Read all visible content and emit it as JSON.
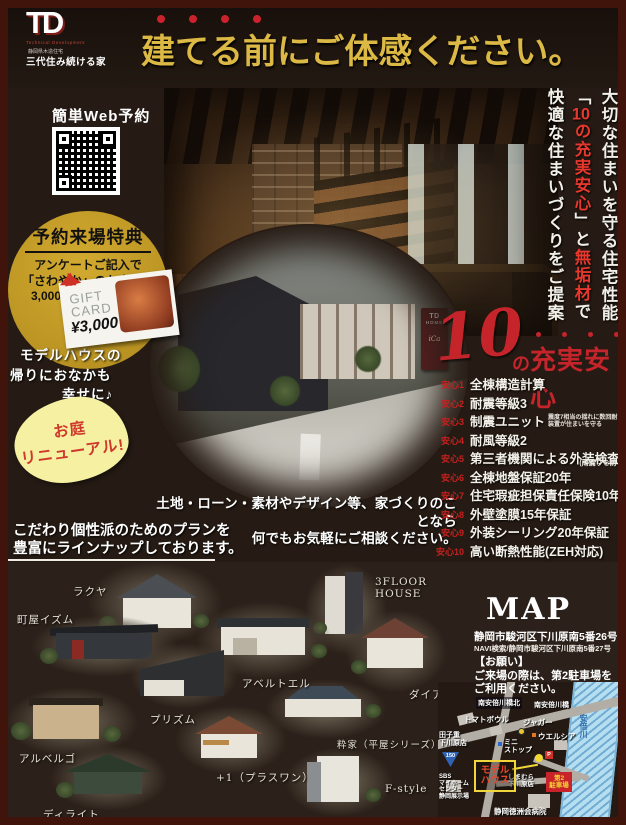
{
  "colors": {
    "accent_red": "#c8232b",
    "title_gold": "#dcb945",
    "circle_gold": "#c49b28",
    "bubble_yellow": "#f6f0a2",
    "map_parking_red": "#c8232b",
    "map_model_yellow": "#f0d63a"
  },
  "brand": {
    "logo": "TD",
    "logo_sub": "Technical Development",
    "tag_small": "静岡県木造住宅",
    "tag_main": "三代住み続ける家"
  },
  "header": {
    "title": "建てる前にご体感ください。"
  },
  "side": {
    "l1": "大切な住まいを守る住宅性能",
    "l2a": "「",
    "l2num": "10",
    "l2b": "の充実安心",
    "l2c": "」と",
    "l2d": "無垢材",
    "l2e": "で",
    "l3": "快適な住まいづくりをご提案"
  },
  "reserve": {
    "label": "簡単Web予約"
  },
  "benefit": {
    "title": "予約来場特典",
    "l1": "アンケートご記入で",
    "l2": "「さわやか」のお食事券",
    "l3": "3,000円分プレゼント",
    "card1": "GIFT",
    "card2": "CARD",
    "card3": "¥3,000"
  },
  "happy": {
    "l1": "モデルハウスの",
    "l2": "帰りにおなかも",
    "l3": "幸せに♪"
  },
  "bubble": {
    "l1": "お庭",
    "l2": "リニューアル!"
  },
  "photo_sign": {
    "l1": "TD",
    "l2": "HOME",
    "l3": "iCa"
  },
  "anshin": {
    "num": "10",
    "no": "の",
    "title": "充実安心",
    "items": [
      {
        "label": "安心1",
        "text": "全棟構造計算"
      },
      {
        "label": "安心2",
        "text": "耐震等級3"
      },
      {
        "label": "安心3",
        "text": "制震ユニット",
        "note1": "震度7相当の揺れに数回耐えた",
        "note2": "装置が住まいを守る"
      },
      {
        "label": "安心4",
        "text": "耐風等級2"
      },
      {
        "label": "安心5",
        "text": "第三者機関による外装検査",
        "note": "(雨漏りを防ぐ)"
      },
      {
        "label": "安心6",
        "text": "全棟地盤保証20年"
      },
      {
        "label": "安心7",
        "text": "住宅瑕疵担保責任保険10年"
      },
      {
        "label": "安心8",
        "text": "外壁塗膜15年保証"
      },
      {
        "label": "安心9",
        "text": "外装シーリング20年保証"
      },
      {
        "label": "安心10",
        "text": "高い断熱性能(ZEH対応)"
      }
    ]
  },
  "consult": {
    "l1": "土地・ローン・素材やデザイン等、家づくりのことなら",
    "l2": "何でもお気軽にご相談ください。"
  },
  "plans": {
    "l1": "こだわり個性派のためのプランを",
    "l2": "豊富にラインナップしております。"
  },
  "houses": [
    {
      "name": "ラクヤ"
    },
    {
      "name": "町屋イズム"
    },
    {
      "name": "3FLOOR HOUSE"
    },
    {
      "name": "アベルトエル"
    },
    {
      "name": "ダイアリー"
    },
    {
      "name": "プリズム"
    },
    {
      "name": "アルベルゴ"
    },
    {
      "name": "粋家（平屋シリーズ）"
    },
    {
      "name": "+1（プラスワン）"
    },
    {
      "name": "F-style"
    },
    {
      "name": "ディライト"
    }
  ],
  "map": {
    "title": "MAP",
    "address": "静岡市駿河区下川原南5番26号",
    "navi": "NAVI検索/静岡市駿河区下川原南5番27号",
    "ask_title": "【お願い】",
    "ask1": "ご来場の際は、第2駐車場を",
    "ask2": "ご利用ください。",
    "labels": {
      "bridge_north": "南安倍川橋北",
      "bridge": "南安倍川橋",
      "tomato": "トマトボウル",
      "jaguar": "ジャガー",
      "welcia": "ウエルシア",
      "tagoju1": "田子重",
      "tagoju2": "下川原店",
      "mini1": "ミニ",
      "mini2": "ストップ",
      "model1": "モデル",
      "model2": "ハウス",
      "shima1": "しまむら",
      "shima2": "下川原店",
      "park1": "第2",
      "park2": "駐車場",
      "hospital": "静岡徳洲会病院",
      "river": "安倍川",
      "route": "150",
      "sbs1": "SBS",
      "sbs2": "マイホーム",
      "sbs3": "センター",
      "sbs4": "静岡展示場",
      "parking_p": "P"
    }
  }
}
